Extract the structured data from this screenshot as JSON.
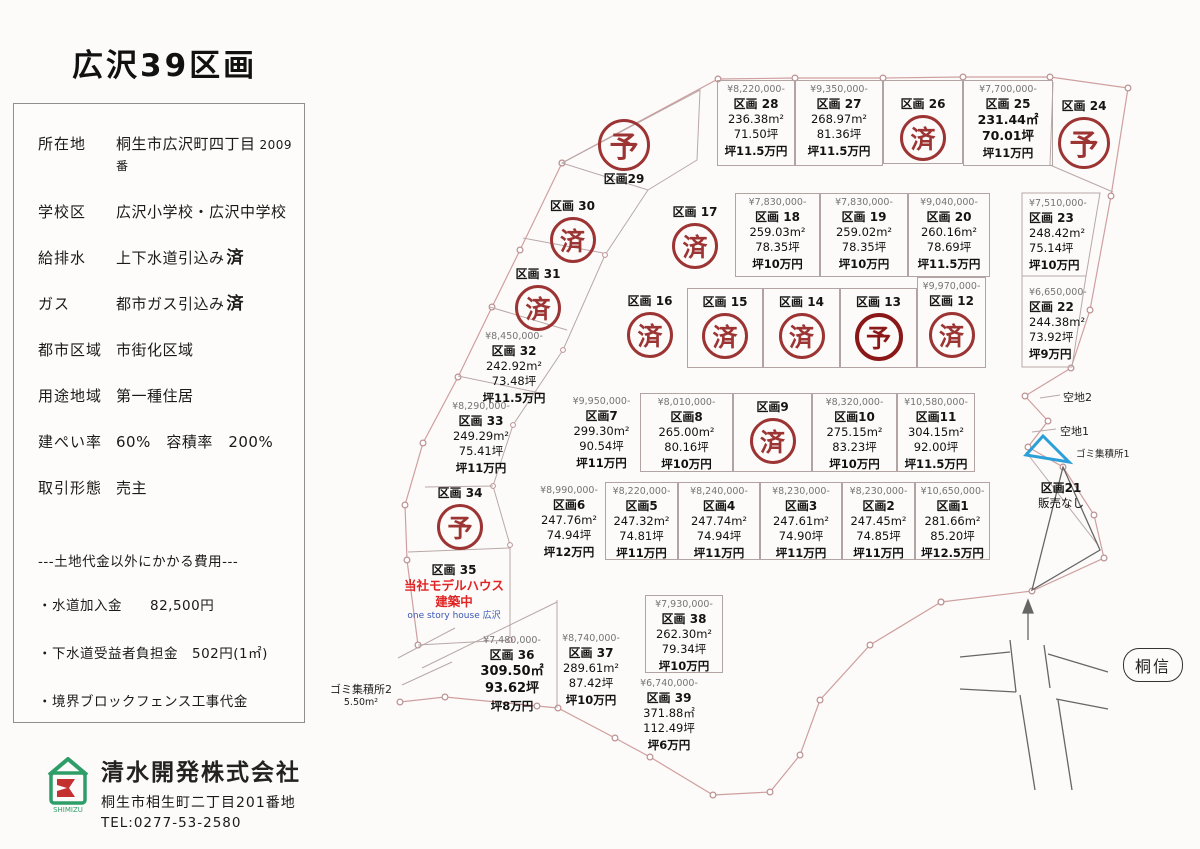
{
  "title": "広沢39区画",
  "info_panel": {
    "rows": [
      {
        "label": "所在地",
        "value": "桐生市広沢町四丁目",
        "suffix": "2009番"
      },
      {
        "label": "学校区",
        "value": "広沢小学校・広沢中学校"
      },
      {
        "label": "給排水",
        "value": "上下水道引込み",
        "suffix_bold": "済"
      },
      {
        "label": "ガス",
        "value": "都市ガス引込み",
        "suffix_bold": "済"
      },
      {
        "label": "都市区域",
        "value": "市街化区域"
      },
      {
        "label": "用途地域",
        "value": "第一種住居"
      },
      {
        "label": "建ぺい率",
        "value": "60%　容積率　200%"
      },
      {
        "label": "取引形態",
        "value": "売主"
      }
    ],
    "costs_header": "---土地代金以外にかかる費用---",
    "costs": [
      "・水道加入金　　82,500円",
      "・下水道受益者負担金　502円(1㎡)",
      "・境界ブロックフェンス工事代金"
    ]
  },
  "company": {
    "name": "清水開発株式会社",
    "address": "桐生市相生町二丁目201番地",
    "tel": "TEL:0277-53-2580",
    "logo_text": "SHIMIZU"
  },
  "lots": {
    "1": {
      "price": "¥10,650,000-",
      "num": "区画1",
      "area": "281.66m²",
      "tsubo": "85.20坪",
      "unit": "坪12.5万円"
    },
    "2": {
      "price": "¥8,230,000-",
      "num": "区画2",
      "area": "247.45m²",
      "tsubo": "74.85坪",
      "unit": "坪11万円"
    },
    "3": {
      "price": "¥8,230,000-",
      "num": "区画3",
      "area": "247.61m²",
      "tsubo": "74.90坪",
      "unit": "坪11万円"
    },
    "4": {
      "price": "¥8,240,000-",
      "num": "区画4",
      "area": "247.74m²",
      "tsubo": "74.94坪",
      "unit": "坪11万円"
    },
    "5": {
      "price": "¥8,220,000-",
      "num": "区画5",
      "area": "247.32m²",
      "tsubo": "74.81坪",
      "unit": "坪11万円"
    },
    "6": {
      "price": "¥8,990,000-",
      "num": "区画6",
      "area": "247.76m²",
      "tsubo": "74.94坪",
      "unit": "坪12万円"
    },
    "7": {
      "price": "¥9,950,000-",
      "num": "区画7",
      "area": "299.30m²",
      "tsubo": "90.54坪",
      "unit": "坪11万円"
    },
    "8": {
      "price": "¥8,010,000-",
      "num": "区画8",
      "area": "265.00m²",
      "tsubo": "80.16坪",
      "unit": "坪10万円"
    },
    "9": {
      "num": "区画9",
      "status": "済"
    },
    "10": {
      "price": "¥8,320,000-",
      "num": "区画10",
      "area": "275.15m²",
      "tsubo": "83.23坪",
      "unit": "坪10万円"
    },
    "11": {
      "price": "¥10,580,000-",
      "num": "区画11",
      "area": "304.15m²",
      "tsubo": "92.00坪",
      "unit": "坪11.5万円"
    },
    "12": {
      "price": "¥9,970,000-",
      "num": "区画 12",
      "status": "済"
    },
    "13": {
      "num": "区画 13",
      "status": "予"
    },
    "14": {
      "num": "区画 14",
      "status": "済"
    },
    "15": {
      "num": "区画 15",
      "status": "済"
    },
    "16": {
      "num": "区画 16",
      "status": "済"
    },
    "17": {
      "num": "区画 17",
      "status": "済"
    },
    "18": {
      "price": "¥7,830,000-",
      "num": "区画 18",
      "area": "259.03m²",
      "tsubo": "78.35坪",
      "unit": "坪10万円"
    },
    "19": {
      "price": "¥7,830,000-",
      "num": "区画 19",
      "area": "259.02m²",
      "tsubo": "78.35坪",
      "unit": "坪10万円"
    },
    "20": {
      "price": "¥9,040,000-",
      "num": "区画 20",
      "area": "260.16m²",
      "tsubo": "78.69坪",
      "unit": "坪11.5万円"
    },
    "21": {
      "num": "区画21",
      "note": "販売なし"
    },
    "22": {
      "price": "¥6,650,000-",
      "num": "区画 22",
      "area": "244.38m²",
      "tsubo": "73.92坪",
      "unit": "坪9万円"
    },
    "23": {
      "price": "¥7,510,000-",
      "num": "区画 23",
      "area": "248.42m²",
      "tsubo": "75.14坪",
      "unit": "坪10万円"
    },
    "24": {
      "num": "区画 24",
      "status": "予"
    },
    "25": {
      "price": "¥7,700,000-",
      "num": "区画 25",
      "area": "231.44㎡",
      "tsubo": "70.01坪",
      "unit": "坪11万円"
    },
    "26": {
      "num": "区画 26",
      "status": "済"
    },
    "27": {
      "price": "¥9,350,000-",
      "num": "区画 27",
      "area": "268.97m²",
      "tsubo": "81.36坪",
      "unit": "坪11.5万円"
    },
    "28": {
      "price": "¥8,220,000-",
      "num": "区画 28",
      "area": "236.38m²",
      "tsubo": "71.50坪",
      "unit": "坪11.5万円"
    },
    "29": {
      "num": "区画29",
      "status": "予"
    },
    "30": {
      "num": "区画 30",
      "status": "済"
    },
    "31": {
      "num": "区画 31",
      "status": "済"
    },
    "32": {
      "price": "¥8,450,000-",
      "num": "区画 32",
      "area": "242.92m²",
      "tsubo": "73.48坪",
      "unit": "坪11.5万円"
    },
    "33": {
      "price": "¥8,290,000-",
      "num": "区画 33",
      "area": "249.29m²",
      "tsubo": "75.41坪",
      "unit": "坪11万円"
    },
    "34": {
      "num": "区画 34",
      "status": "予"
    },
    "35": {
      "num": "区画 35",
      "note1": "当社モデルハウス",
      "note2": "建築中",
      "note3": "one story house 広沢"
    },
    "36": {
      "price": "¥7,480,000-",
      "num": "区画 36",
      "area": "309.50㎡",
      "tsubo": "93.62坪",
      "unit": "坪8万円"
    },
    "37": {
      "price": "¥8,740,000-",
      "num": "区画 37",
      "area": "289.61m²",
      "tsubo": "87.42坪",
      "unit": "坪10万円"
    },
    "38": {
      "price": "¥7,930,000-",
      "num": "区画 38",
      "area": "262.30m²",
      "tsubo": "79.34坪",
      "unit": "坪10万円"
    },
    "39": {
      "price": "¥6,740,000-",
      "num": "区画 39",
      "area": "371.88㎡",
      "tsubo": "112.49坪",
      "unit": "坪6万円"
    }
  },
  "extras": {
    "open2": "空地2",
    "open1": "空地1",
    "trash1": "ゴミ集積所1",
    "trash2": "ゴミ集積所2",
    "trash2_area": "5.50m²",
    "bank": "桐信"
  },
  "colors": {
    "stamp_red": "#9c3434",
    "stamp_red_heavy": "#8b1818",
    "price_gray": "#757575",
    "boundary_pink": "#cf9f9f",
    "model_house_red": "#e02424",
    "annotation_blue": "#3a57b5",
    "trash_triangle_blue": "#2b9fd8",
    "logo_green": "#2e9e68",
    "logo_red": "#c23030"
  }
}
